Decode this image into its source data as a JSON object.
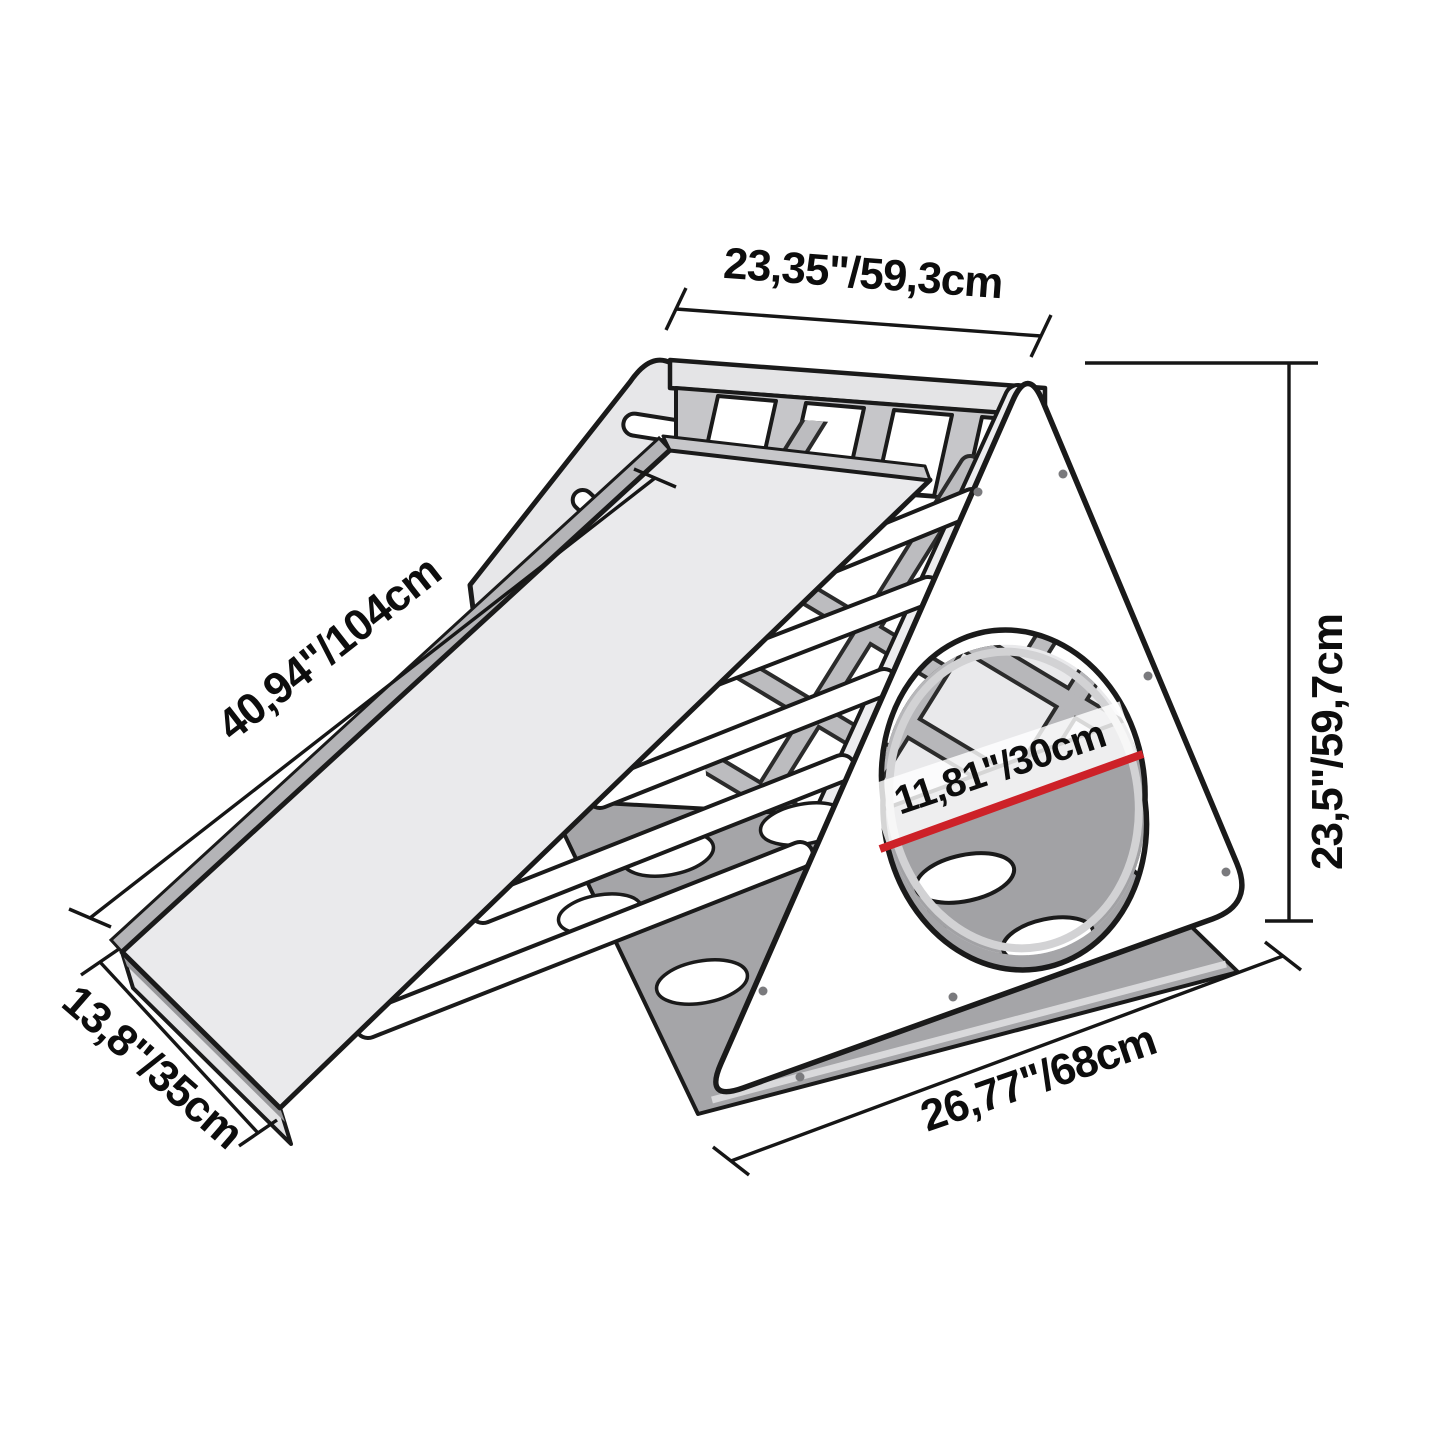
{
  "diagram_type": "product dimension diagram",
  "product": "climbing triangle with ladder, climbing net and slide ramp",
  "labels": {
    "top_width": "23,35\"/59,3cm",
    "slide_length": "40,94\"/104cm",
    "slide_width": "13,8\"/35cm",
    "base_length": "26,77\"/68cm",
    "height": "23,5\"/59,7cm",
    "porthole_diameter": "11,81\"/30cm"
  },
  "colors": {
    "outline": "#1a1a1a",
    "panel_light": "#eaeaec",
    "panel_mid": "#c7c7ca",
    "panel_dark": "#a5a5a8",
    "dimension_red": "#cd2128",
    "background": "#ffffff"
  }
}
